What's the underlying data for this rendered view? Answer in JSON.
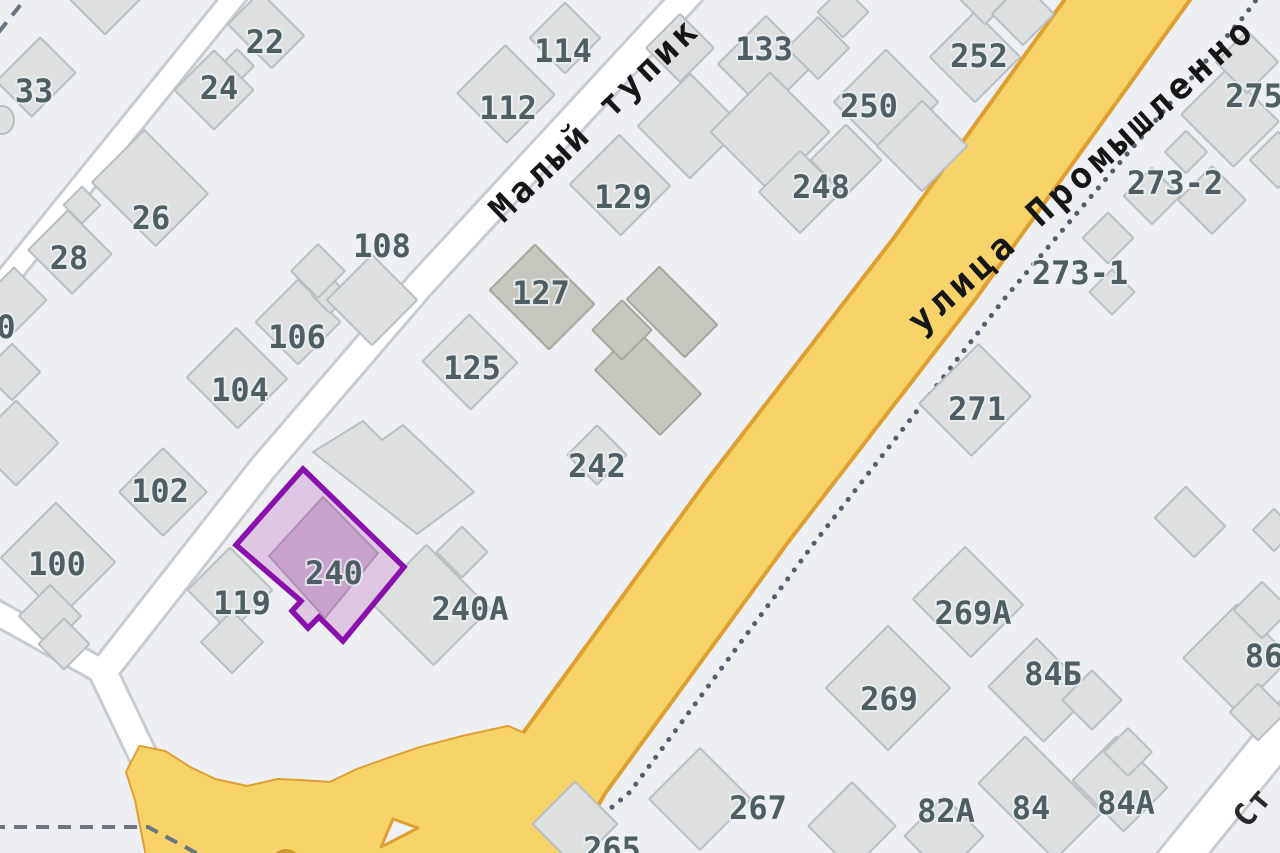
{
  "map": {
    "title": "map-fragment",
    "width": 1280,
    "height": 853,
    "background": "#edeff3",
    "colors": {
      "building_fill": "#dde0df",
      "building_stroke": "#b8bec2",
      "building_dark_fill": "#c6c7be",
      "building_dark_stroke": "#a6a79d",
      "road_white_fill": "#ffffff",
      "road_white_casing": "#c6ccd2",
      "road_yellow_fill": "#f8d369",
      "road_yellow_casing": "#dfa032",
      "boundary_dotted": "#555f6d",
      "boundary_dashed": "#6b7580",
      "label_gray": "#4f5e63",
      "street_label_black": "#161616",
      "highlight_stroke": "#8912ad",
      "highlight_fill": "#ddc2e2",
      "highlight_building_fill": "#c7a3cc",
      "highlight_building_stroke": "#ad8fb3",
      "island_fill": "#eef0f4",
      "letter_blob_fill": "#d3992a"
    },
    "highlight": {
      "label": "240",
      "label_x": 334,
      "label_y": 573,
      "outline": [
        [
          303,
          469
        ],
        [
          404,
          567
        ],
        [
          343,
          641
        ],
        [
          319,
          617
        ],
        [
          308,
          628
        ],
        [
          292,
          611
        ],
        [
          301,
          601
        ],
        [
          236,
          545
        ]
      ],
      "inner_building": [
        [
          323,
          497
        ],
        [
          378,
          553
        ],
        [
          325,
          618
        ],
        [
          269,
          556
        ]
      ]
    },
    "street_labels": [
      {
        "t": "Малый тупик",
        "x": 595,
        "y": 120,
        "rot": -44,
        "size": 35,
        "ls": 4,
        "color": "#161616"
      },
      {
        "t": "улица Промышленно",
        "x": 1082,
        "y": 175,
        "rot": -42,
        "size": 36,
        "ls": 5,
        "color": "#161616"
      },
      {
        "t": "Ст",
        "x": 1253,
        "y": 807,
        "rot": -50,
        "size": 31,
        "ls": 2,
        "color": "#2a2a2a"
      }
    ],
    "house_labels": [
      {
        "t": "22",
        "x": 265,
        "y": 42
      },
      {
        "t": "24",
        "x": 219,
        "y": 88
      },
      {
        "t": "33",
        "x": 34,
        "y": 91
      },
      {
        "t": "26",
        "x": 151,
        "y": 218
      },
      {
        "t": "28",
        "x": 69,
        "y": 258
      },
      {
        "t": "0",
        "x": 6,
        "y": 327
      },
      {
        "t": "108",
        "x": 382,
        "y": 246
      },
      {
        "t": "106",
        "x": 297,
        "y": 337
      },
      {
        "t": "104",
        "x": 240,
        "y": 390
      },
      {
        "t": "102",
        "x": 160,
        "y": 491
      },
      {
        "t": "100",
        "x": 57,
        "y": 564
      },
      {
        "t": "114",
        "x": 563,
        "y": 51
      },
      {
        "t": "112",
        "x": 508,
        "y": 108
      },
      {
        "t": "125",
        "x": 472,
        "y": 368
      },
      {
        "t": "127",
        "x": 541,
        "y": 293
      },
      {
        "t": "129",
        "x": 623,
        "y": 197
      },
      {
        "t": "133",
        "x": 764,
        "y": 49
      },
      {
        "t": "119",
        "x": 242,
        "y": 603
      },
      {
        "t": "240А",
        "x": 470,
        "y": 609
      },
      {
        "t": "242",
        "x": 597,
        "y": 466
      },
      {
        "t": "248",
        "x": 821,
        "y": 187
      },
      {
        "t": "250",
        "x": 869,
        "y": 106
      },
      {
        "t": "252",
        "x": 979,
        "y": 56
      },
      {
        "t": "275",
        "x": 1254,
        "y": 96
      },
      {
        "t": "273-2",
        "x": 1175,
        "y": 183
      },
      {
        "t": "273-1",
        "x": 1080,
        "y": 273
      },
      {
        "t": "271",
        "x": 977,
        "y": 409
      },
      {
        "t": "269А",
        "x": 973,
        "y": 613
      },
      {
        "t": "269",
        "x": 889,
        "y": 699
      },
      {
        "t": "84Б",
        "x": 1053,
        "y": 674
      },
      {
        "t": "86",
        "x": 1264,
        "y": 656
      },
      {
        "t": "82А",
        "x": 946,
        "y": 811
      },
      {
        "t": "84",
        "x": 1031,
        "y": 808
      },
      {
        "t": "84А",
        "x": 1126,
        "y": 803
      },
      {
        "t": "267",
        "x": 758,
        "y": 808
      },
      {
        "t": "265",
        "x": 612,
        "y": 849
      }
    ],
    "roads_white": [
      {
        "name": "road-top-left",
        "pts": [
          [
            248,
            -20
          ],
          [
            -35,
            330
          ]
        ],
        "w": 20
      },
      {
        "name": "road-maly-tupik",
        "pts": [
          [
            697,
            -15
          ],
          [
            420,
            285
          ],
          [
            263,
            468
          ],
          [
            103,
            672
          ],
          [
            170,
            812
          ]
        ],
        "w": 26
      },
      {
        "name": "road-west-branch",
        "pts": [
          [
            -30,
            598
          ],
          [
            103,
            672
          ]
        ],
        "w": 22
      },
      {
        "name": "road-bottom-right",
        "pts": [
          [
            1168,
            872
          ],
          [
            1298,
            712
          ]
        ],
        "w": 38
      }
    ],
    "road_yellow": {
      "name": "road-promyshlennaya",
      "pts": [
        [
          1163,
          -50
        ],
        [
          935,
          268
        ],
        [
          747,
          512
        ],
        [
          562,
          766
        ],
        [
          498,
          880
        ]
      ],
      "w": 98
    },
    "junction_flare": [
      [
        140,
        747
      ],
      [
        165,
        752
      ],
      [
        190,
        768
      ],
      [
        215,
        780
      ],
      [
        247,
        787
      ],
      [
        278,
        780
      ],
      [
        300,
        781
      ],
      [
        330,
        783
      ],
      [
        357,
        770
      ],
      [
        385,
        760
      ],
      [
        420,
        748
      ],
      [
        462,
        737
      ],
      [
        508,
        727
      ],
      [
        585,
        760
      ],
      [
        545,
        872
      ],
      [
        150,
        872
      ],
      [
        136,
        800
      ],
      [
        127,
        772
      ]
    ],
    "traffic_island": [
      [
        393,
        819
      ],
      [
        418,
        828
      ],
      [
        381,
        847
      ]
    ],
    "letter_blob": {
      "cx": 286,
      "cy": 864,
      "r": 15
    },
    "boundary_dotted_pts": [
      [
        1262,
        -8
      ],
      [
        1245,
        15
      ],
      [
        1005,
        298
      ],
      [
        815,
        542
      ],
      [
        630,
        792
      ],
      [
        540,
        868
      ]
    ],
    "boundary_dashed_pts": [
      [
        -8,
        827
      ],
      [
        148,
        827
      ],
      [
        200,
        855
      ],
      [
        216,
        868
      ]
    ],
    "corner_dashes_pts": [
      [
        34,
        -12
      ],
      [
        -22,
        58
      ]
    ],
    "buildings": [
      {
        "cx": 105,
        "cy": -8,
        "w": 60,
        "h": 60
      },
      {
        "cx": 36,
        "cy": 77,
        "w": 50,
        "h": 62
      },
      {
        "cx": 266,
        "cy": 30,
        "w": 62,
        "h": 46
      },
      {
        "cx": 237,
        "cy": 66,
        "w": 24,
        "h": 24
      },
      {
        "cx": 214,
        "cy": 90,
        "w": 56,
        "h": 56
      },
      {
        "cx": 150,
        "cy": 188,
        "w": 90,
        "h": 74
      },
      {
        "cx": 82,
        "cy": 205,
        "w": 26,
        "h": 26
      },
      {
        "cx": 70,
        "cy": 252,
        "w": 62,
        "h": 56
      },
      {
        "cx": 14,
        "cy": 300,
        "w": 46,
        "h": 46
      },
      {
        "cx": 12,
        "cy": 372,
        "w": 40,
        "h": 40
      },
      {
        "cx": 16,
        "cy": 443,
        "w": 60,
        "h": 60
      },
      {
        "cx": 58,
        "cy": 560,
        "w": 84,
        "h": 78
      },
      {
        "cx": 163,
        "cy": 492,
        "w": 62,
        "h": 62
      },
      {
        "cx": 237,
        "cy": 378,
        "w": 72,
        "h": 70
      },
      {
        "cx": 298,
        "cy": 322,
        "w": 60,
        "h": 60
      },
      {
        "cx": 330,
        "cy": 295,
        "w": 26,
        "h": 26
      },
      {
        "cx": 318,
        "cy": 271,
        "w": 38,
        "h": 38
      },
      {
        "cx": 372,
        "cy": 300,
        "w": 64,
        "h": 64
      },
      {
        "cx": 565,
        "cy": 38,
        "w": 50,
        "h": 50
      },
      {
        "cx": 506,
        "cy": 94,
        "w": 70,
        "h": 68
      },
      {
        "cx": 470,
        "cy": 362,
        "w": 68,
        "h": 66
      },
      {
        "cx": 542,
        "cy": 297,
        "w": 84,
        "h": 64,
        "dark": true
      },
      {
        "cx": 672,
        "cy": 312,
        "w": 82,
        "h": 46,
        "dark": true
      },
      {
        "cx": 648,
        "cy": 382,
        "w": 92,
        "h": 58,
        "dark": true
      },
      {
        "cx": 622,
        "cy": 330,
        "w": 42,
        "h": 42,
        "dark": true
      },
      {
        "cx": 597,
        "cy": 455,
        "w": 42,
        "h": 42
      },
      {
        "cx": 620,
        "cy": 185,
        "w": 72,
        "h": 70
      },
      {
        "cx": 690,
        "cy": 126,
        "w": 74,
        "h": 74
      },
      {
        "cx": 680,
        "cy": 48,
        "w": 48,
        "h": 48
      },
      {
        "cx": 766,
        "cy": 64,
        "w": 68,
        "h": 68
      },
      {
        "cx": 818,
        "cy": 48,
        "w": 44,
        "h": 44
      },
      {
        "cx": 843,
        "cy": 12,
        "w": 36,
        "h": 36
      },
      {
        "cx": 770,
        "cy": 132,
        "w": 84,
        "h": 84
      },
      {
        "cx": 800,
        "cy": 192,
        "w": 58,
        "h": 58
      },
      {
        "cx": 846,
        "cy": 160,
        "w": 50,
        "h": 50
      },
      {
        "cx": 886,
        "cy": 102,
        "w": 74,
        "h": 74
      },
      {
        "cx": 922,
        "cy": 146,
        "w": 64,
        "h": 64
      },
      {
        "cx": 975,
        "cy": 57,
        "w": 64,
        "h": 64
      },
      {
        "cx": 985,
        "cy": -4,
        "w": 40,
        "h": 40
      },
      {
        "cx": 1023,
        "cy": 14,
        "w": 44,
        "h": 44
      },
      {
        "cx": 1230,
        "cy": 118,
        "w": 74,
        "h": 64
      },
      {
        "cx": 1247,
        "cy": 62,
        "w": 44,
        "h": 44
      },
      {
        "cx": 1278,
        "cy": 160,
        "w": 40,
        "h": 40
      },
      {
        "cx": 1152,
        "cy": 196,
        "w": 40,
        "h": 40
      },
      {
        "cx": 1212,
        "cy": 200,
        "w": 48,
        "h": 48
      },
      {
        "cx": 1186,
        "cy": 152,
        "w": 30,
        "h": 30
      },
      {
        "cx": 1108,
        "cy": 238,
        "w": 36,
        "h": 36
      },
      {
        "cx": 1112,
        "cy": 292,
        "w": 32,
        "h": 32
      },
      {
        "cx": 975,
        "cy": 400,
        "w": 74,
        "h": 84
      },
      {
        "cx": 1190,
        "cy": 522,
        "w": 56,
        "h": 44
      },
      {
        "cx": 1274,
        "cy": 530,
        "w": 30,
        "h": 30
      },
      {
        "cx": 230,
        "cy": 590,
        "w": 60,
        "h": 60
      },
      {
        "cx": 232,
        "cy": 642,
        "w": 44,
        "h": 44
      },
      {
        "cx": 50,
        "cy": 616,
        "w": 44,
        "h": 44
      },
      {
        "cx": 64,
        "cy": 644,
        "w": 36,
        "h": 36
      },
      {
        "cx": 430,
        "cy": 605,
        "w": 90,
        "h": 80
      },
      {
        "cx": 462,
        "cy": 552,
        "w": 36,
        "h": 36
      },
      {
        "cx": 575,
        "cy": 824,
        "w": 60,
        "h": 60
      },
      {
        "cx": 700,
        "cy": 799,
        "w": 72,
        "h": 72
      },
      {
        "cx": 852,
        "cy": 826,
        "w": 62,
        "h": 62
      },
      {
        "cx": 888,
        "cy": 688,
        "w": 88,
        "h": 88
      },
      {
        "cx": 968,
        "cy": 602,
        "w": 82,
        "h": 74
      },
      {
        "cx": 1040,
        "cy": 690,
        "w": 78,
        "h": 68
      },
      {
        "cx": 1092,
        "cy": 700,
        "w": 42,
        "h": 42
      },
      {
        "cx": 1040,
        "cy": 798,
        "w": 108,
        "h": 66
      },
      {
        "cx": 944,
        "cy": 836,
        "w": 56,
        "h": 56
      },
      {
        "cx": 1120,
        "cy": 784,
        "w": 72,
        "h": 62
      },
      {
        "cx": 1128,
        "cy": 752,
        "w": 34,
        "h": 34
      },
      {
        "cx": 1237,
        "cy": 658,
        "w": 76,
        "h": 76
      },
      {
        "cx": 1262,
        "cy": 610,
        "w": 40,
        "h": 40
      },
      {
        "cx": 1258,
        "cy": 712,
        "w": 40,
        "h": 40
      }
    ],
    "building_polys": [
      {
        "pts": [
          [
            313,
            452
          ],
          [
            363,
            421
          ],
          [
            382,
            440
          ],
          [
            403,
            425
          ],
          [
            474,
            492
          ],
          [
            417,
            534
          ]
        ]
      }
    ],
    "left_edge_ellipse": {
      "cx": 2,
      "cy": 120,
      "rx": 12,
      "ry": 14
    }
  }
}
